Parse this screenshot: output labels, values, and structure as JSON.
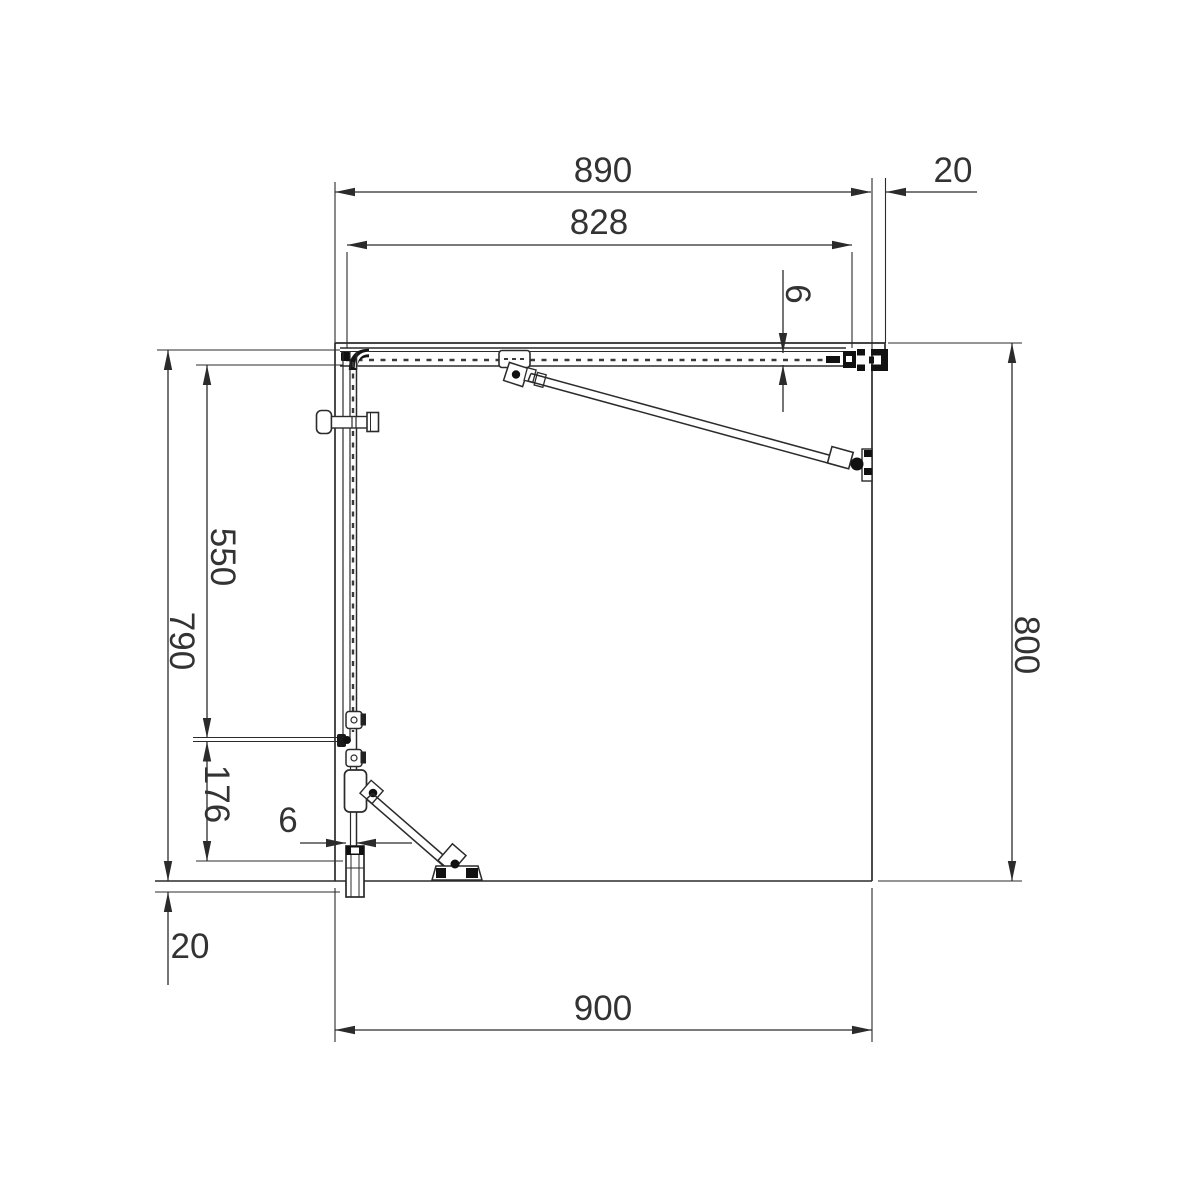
{
  "diagram": {
    "type": "technical-plan-drawing",
    "subject": "corner shower enclosure top view with glass panels, support bars and wall profiles",
    "units_shown": false
  },
  "dimensions": {
    "top_overall": "890",
    "top_wall_profile": "20",
    "top_glass": "828",
    "top_glass_thickness": "6",
    "right_overall": "800",
    "left_overall": "790",
    "left_fixed_glass": "550",
    "left_return_panel": "176",
    "left_glass_thickness": "6",
    "left_wall_profile": "20",
    "bottom_overall": "900"
  },
  "colors": {
    "background": "#ffffff",
    "line": "#2b2b2b",
    "text": "#333333",
    "hardware": "#111111"
  }
}
